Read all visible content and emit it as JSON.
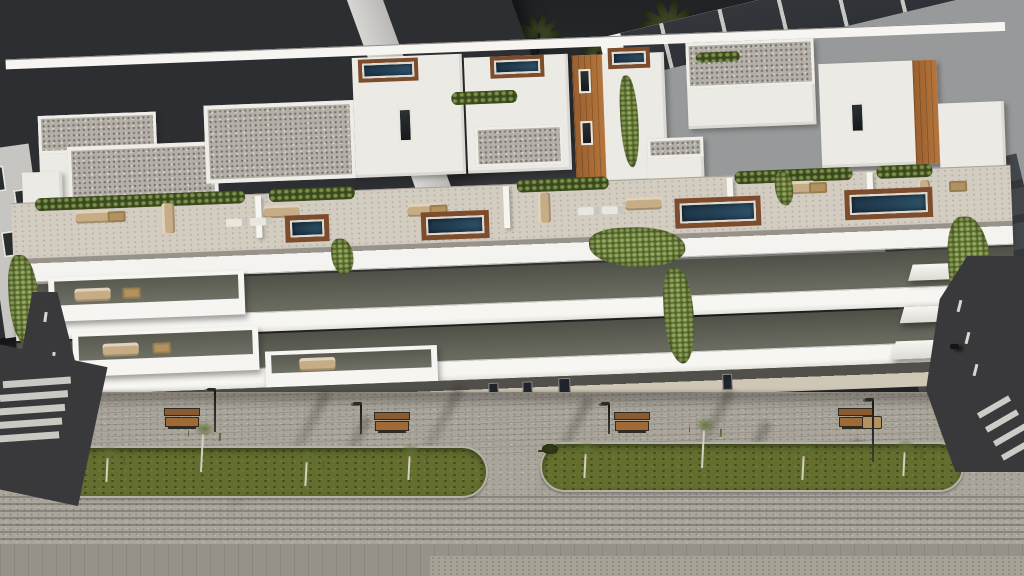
{
  "scene": {
    "title": "Residential complex exterior 3D render",
    "description": "Aerial dusk rendering of a modern white apartment building with rooftop pool terraces, timber-clad balconies, cascading vines and a landscaped pedestrian promenade",
    "time_of_day": "dusk",
    "environment": {
      "sky": "dark overcast dusk sky",
      "palm_trees": 11
    }
  },
  "palette": {
    "sky": "#202225",
    "skyLow": "#33353a",
    "palm": "#3f4828",
    "trunk": "#17170f",
    "bldDark": "#2c2e31",
    "frame": "#e5e5e2",
    "pane": "#17181a",
    "glass": "#2e3236",
    "white": "#eceae4",
    "white2": "#f6f5f1",
    "gravel": "#b4afa7",
    "wood": "#b5763c",
    "woodD": "#9a5f2e",
    "win": "#2a2d2f",
    "recess": "#6d6f63",
    "pool": "#243f54",
    "deck": "#7c4c2c",
    "terrace": "#d3ccc0",
    "hedge": "#4c5c28",
    "vine": "#6a7e3c",
    "furn": "#c7ad85",
    "furnD": "#b2925f",
    "paver": "#a9a59b",
    "walk": "#cfc7b5",
    "plinth": "#504f49",
    "median": "#646e2e",
    "shrub": "#333d1b",
    "curb": "#b5b1a6",
    "road": "#39393b",
    "mark": "#d9d8d2",
    "benchwood": "#8a5a30"
  },
  "background_buildings": {
    "left": {
      "style": "dark charcoal block with white-framed balcony grid"
    },
    "right": {
      "style": "light slab building with dark glass balcony bands"
    }
  },
  "main_building": {
    "visible_floor_levels": 4,
    "rooftop": {
      "pools": 7,
      "roof_finish": "grey gravel",
      "terraces": "furnished with sofas, dining sets and sun loungers",
      "planting": "hedge strips along parapets"
    },
    "facade": {
      "materials": [
        "white render",
        "timber slat cladding",
        "dark glazing"
      ],
      "features": [
        "continuous white balcony slabs",
        "cascading vine planting",
        "recessed balconies"
      ]
    }
  },
  "streetscape": {
    "planted_medians": 2,
    "street_trees_per_median": 4,
    "shrubs_per_median": 10,
    "benches": 4,
    "picnic_tables": 1,
    "lampposts": 4,
    "left_road": {
      "markings": [
        "zebra crossing",
        "lane dashes"
      ]
    },
    "right_road": {
      "markings": [
        "zebra crossing",
        "lane dashes"
      ],
      "parked_scooter": true
    },
    "paving": "grey concrete block pavers"
  }
}
